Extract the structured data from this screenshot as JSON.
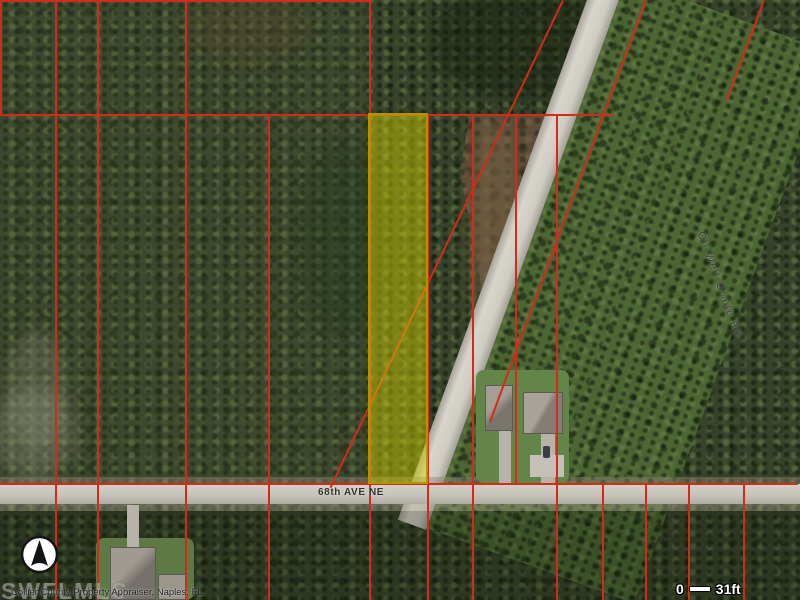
{
  "roads": {
    "avenue": "68th AVE NE",
    "grade_road": "Oil Well Grade RD"
  },
  "scale_bar": {
    "start_label": "0",
    "end_label": "31ft"
  },
  "attribution": "Collier County Property Appraiser, Naples, FL.",
  "watermark": "SWFLMLS",
  "icons": {
    "compass": "north-arrow"
  },
  "colors": {
    "parcel_line": "#d22b1a",
    "highlight_fill": "#d4d200",
    "highlight_border": "#a89a00",
    "road_surface": "#cfccc4"
  }
}
